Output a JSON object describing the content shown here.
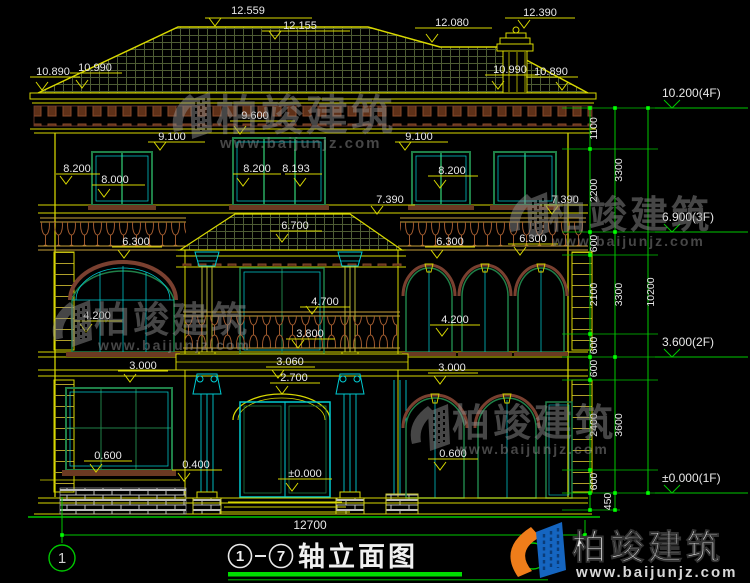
{
  "title": {
    "axis_start": "1",
    "axis_end": "7",
    "name": "轴立面图"
  },
  "axis": {
    "left": "1"
  },
  "watermark": {
    "brand": "柏竣建筑",
    "url": "www.baijunjz.com"
  },
  "dims": {
    "top": [
      "12.559",
      "12.155",
      "12.080",
      "12.390"
    ],
    "eave": [
      "10.890",
      "10.990",
      "10.990",
      "10.890"
    ],
    "f3": [
      "9.600",
      "9.100",
      "9.100",
      "8.200",
      "8.000",
      "8.200",
      "8.193",
      "8.200",
      "7.390",
      "7.390"
    ],
    "f2": [
      "6.700",
      "6.300",
      "6.300",
      "6.300",
      "4.700",
      "4.200",
      "4.200",
      "3.800",
      "3.060",
      "2.700",
      "3.000",
      "3.000"
    ],
    "f1": [
      "0.600",
      "0.400",
      "±0.000",
      "0.600"
    ],
    "total_width": "12700",
    "right_small": [
      "1100",
      "2200",
      "600",
      "2100",
      "600",
      "600",
      "2400",
      "600",
      "450"
    ],
    "right_mid": [
      "3300",
      "3300",
      "3600"
    ],
    "right_total": "10200",
    "levels": [
      "10.200(4F)",
      "6.900(3F)",
      "3.600(2F)",
      "±0.000(1F)"
    ]
  }
}
